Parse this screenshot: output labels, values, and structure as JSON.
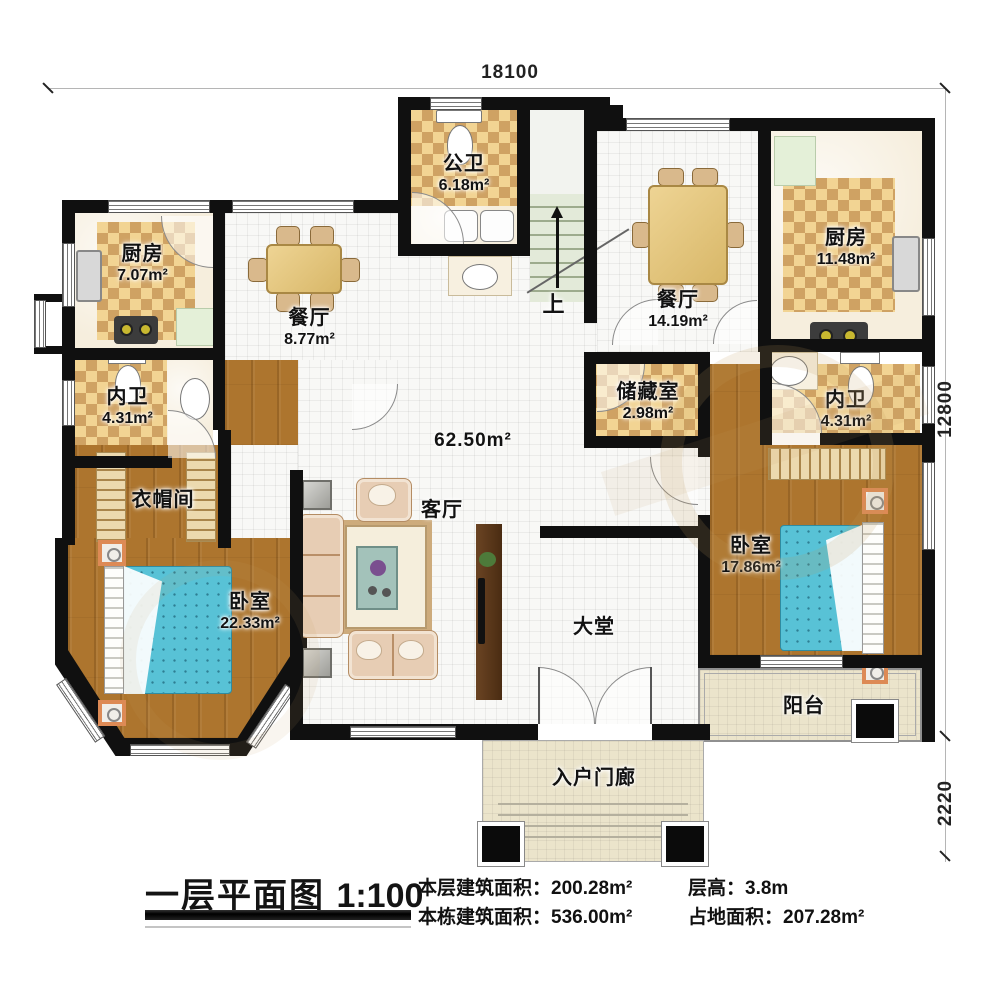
{
  "dimensions": {
    "top_width": "18100",
    "right_height": "12800",
    "porch_depth": "2220"
  },
  "rooms": {
    "public_bath": {
      "name": "公卫",
      "area": "6.18m²"
    },
    "kitchen_left": {
      "name": "厨房",
      "area": "7.07m²"
    },
    "dining_left": {
      "name": "餐厅",
      "area": "8.77m²"
    },
    "dining_right": {
      "name": "餐厅",
      "area": "14.19m²"
    },
    "kitchen_right": {
      "name": "厨房",
      "area": "11.48m²"
    },
    "bath_left": {
      "name": "内卫",
      "area": "4.31m²"
    },
    "bath_right": {
      "name": "内卫",
      "area": "4.31m²"
    },
    "storage": {
      "name": "储藏室",
      "area": "2.98m²"
    },
    "cloakroom": {
      "name": "衣帽间"
    },
    "bedroom_left": {
      "name": "卧室",
      "area": "22.33m²"
    },
    "bedroom_right": {
      "name": "卧室",
      "area": "17.86m²"
    },
    "living": {
      "name": "客厅"
    },
    "hall": {
      "name": "大堂",
      "area": "62.50m²"
    },
    "balcony": {
      "name": "阳台"
    },
    "porch": {
      "name": "入户门廊"
    },
    "stairs": {
      "up_label": "上"
    }
  },
  "title_block": {
    "title": "一层平面图",
    "scale": "1:100",
    "floor_area_label": "本层建筑面积：",
    "floor_area_value": "200.28m²",
    "total_area_label": "本栋建筑面积：",
    "total_area_value": "536.00m²",
    "story_height_label": "层高：",
    "story_height_value": "3.8m",
    "footprint_label": "占地面积：",
    "footprint_value": "207.28m²"
  }
}
